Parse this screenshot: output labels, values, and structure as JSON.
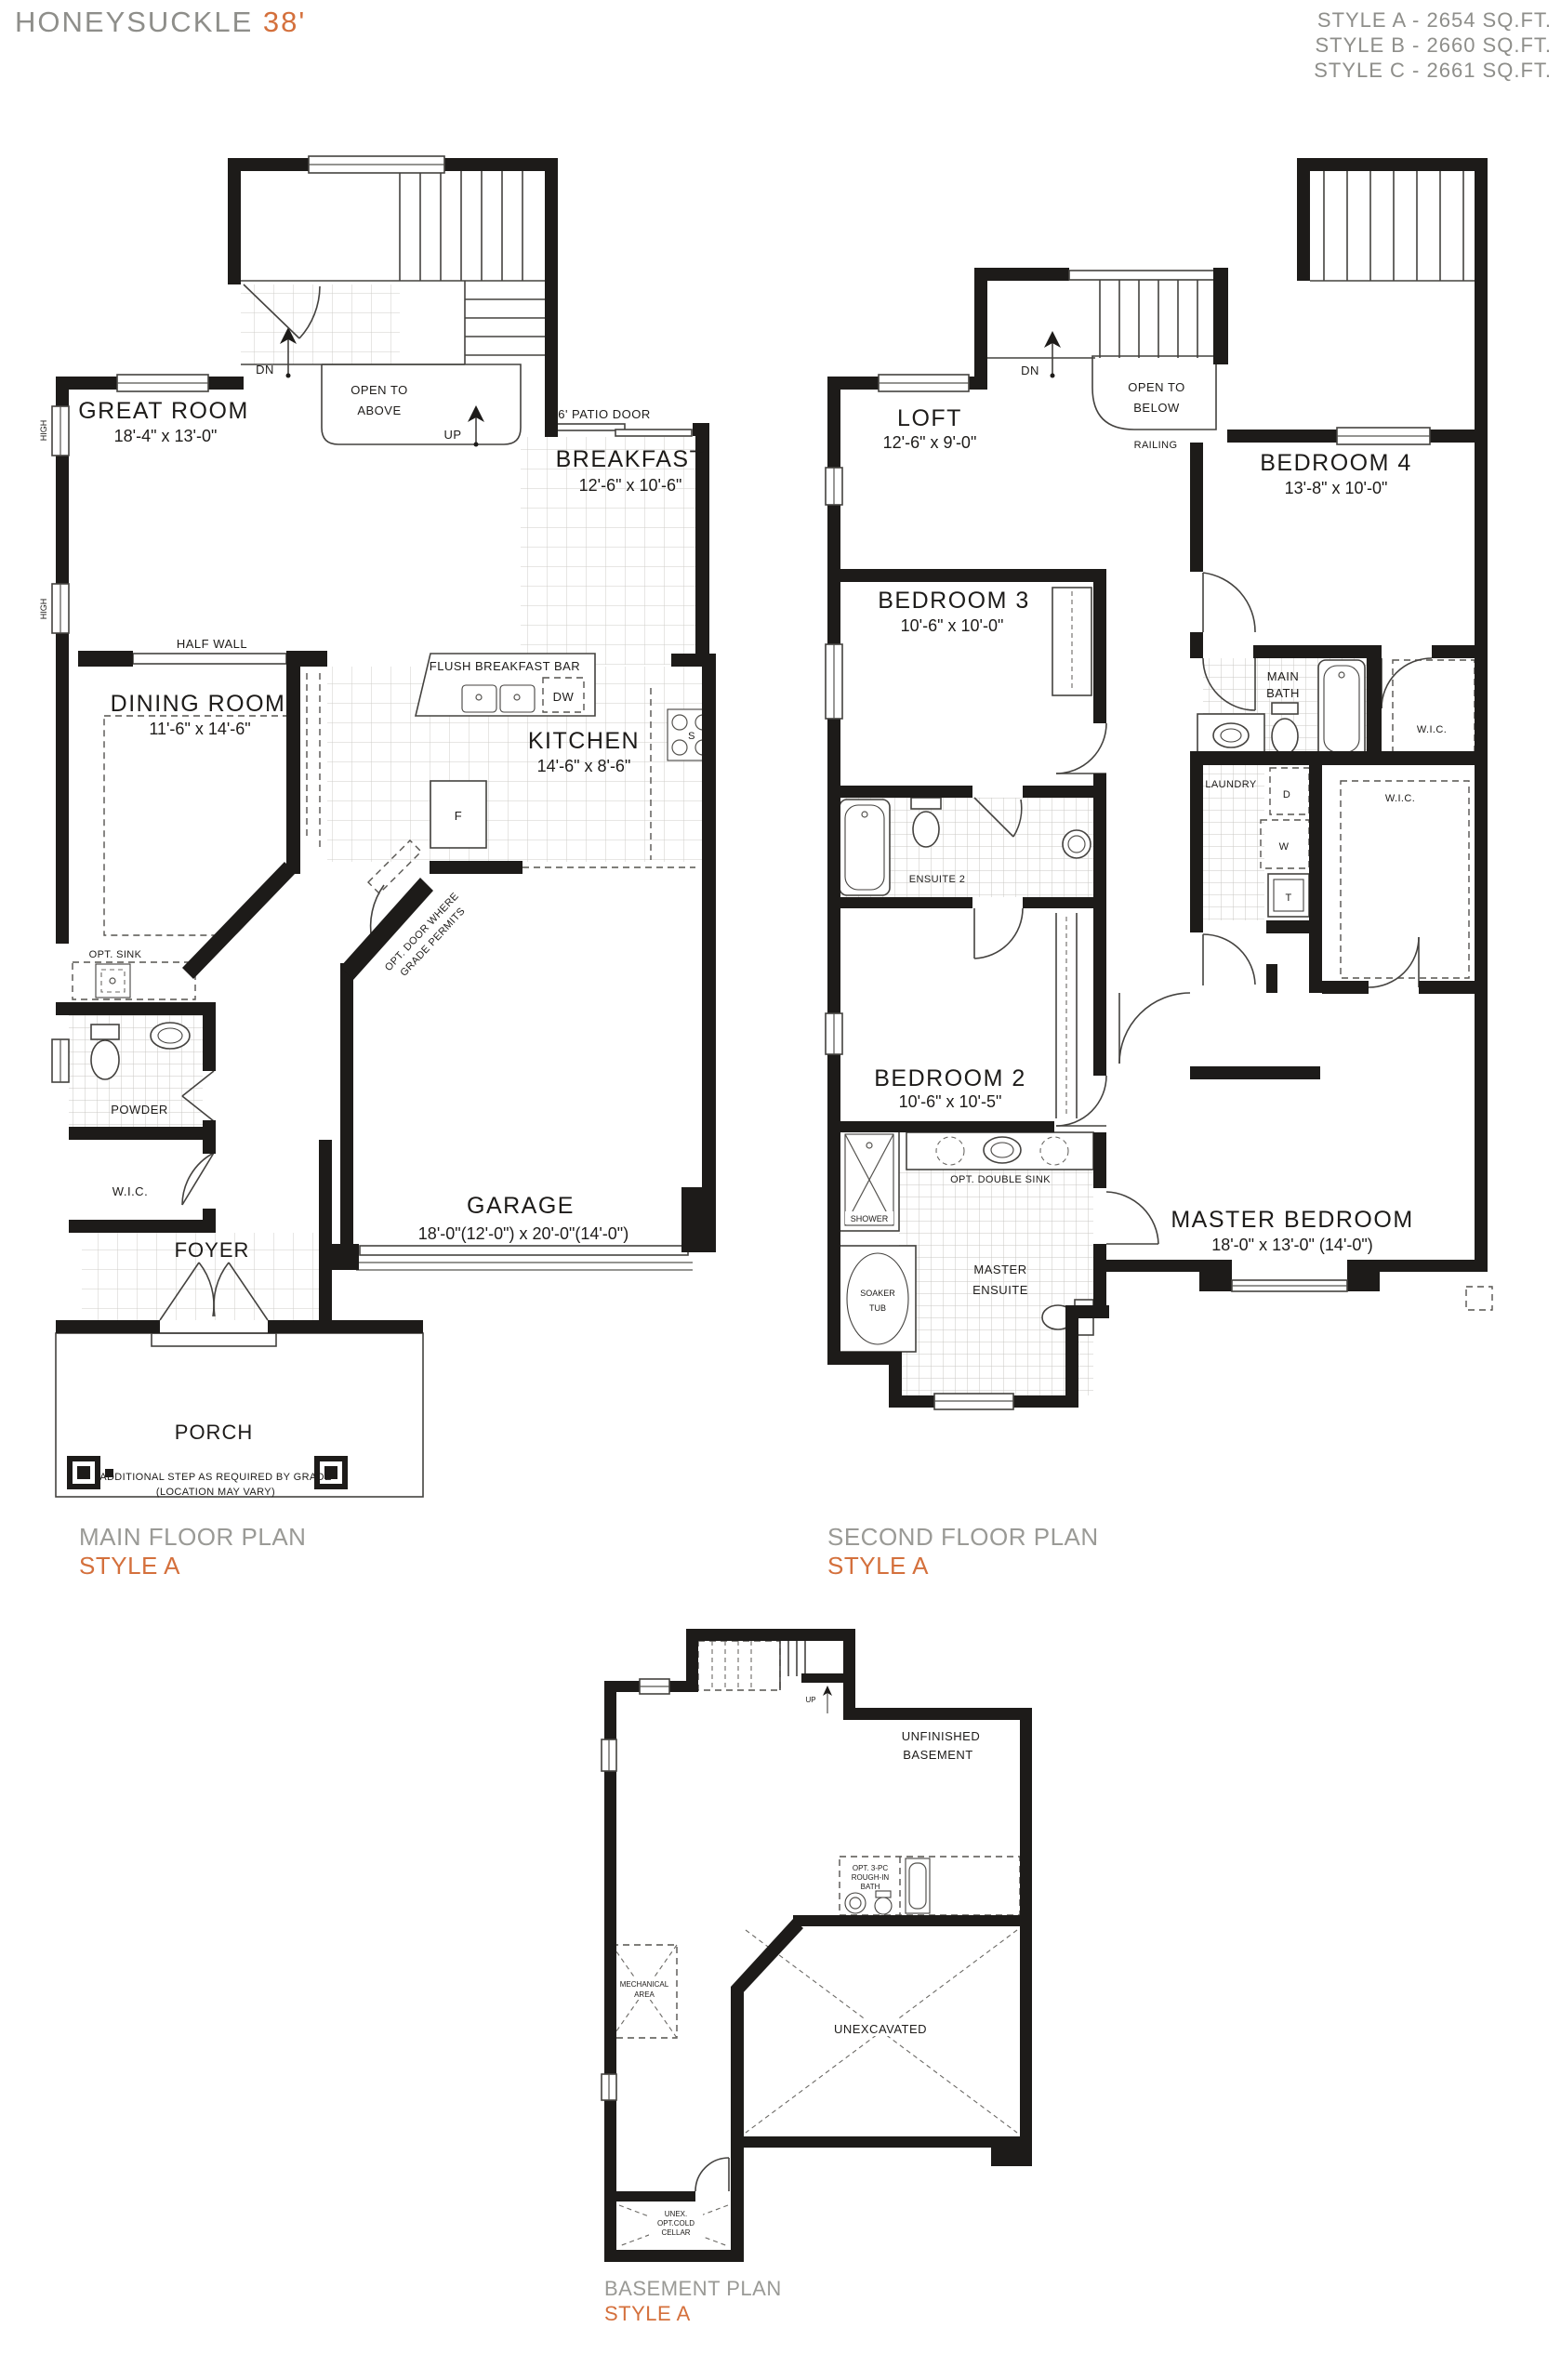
{
  "header": {
    "title_name": "HONEYSUCKLE",
    "title_size": "38'",
    "styles": [
      "STYLE A - 2654 SQ.FT.",
      "STYLE B - 2660 SQ.FT.",
      "STYLE C - 2661 SQ.FT."
    ]
  },
  "colors": {
    "accent": "#D4703C",
    "heading_gray": "#8E8E8A",
    "wall": "#1D1B19"
  },
  "main_floor": {
    "caption": "MAIN FLOOR PLAN",
    "style": "STYLE A",
    "rooms": {
      "great_room": {
        "name": "GREAT ROOM",
        "dims": "18'-4\" x 13'-0\""
      },
      "breakfast": {
        "name": "BREAKFAST",
        "dims": "12'-6\" x 10'-6\""
      },
      "dining_room": {
        "name": "DINING ROOM",
        "dims": "11'-6\" x 14'-6\""
      },
      "kitchen": {
        "name": "KITCHEN",
        "dims": "14'-6\" x 8'-6\""
      },
      "garage": {
        "name": "GARAGE",
        "dims": "18'-0\"(12'-0\") x 20'-0\"(14'-0\")"
      },
      "powder": "POWDER",
      "wic": "W.I.C.",
      "foyer": "FOYER",
      "porch": "PORCH"
    },
    "labels": {
      "high": "HIGH",
      "dn": "DN",
      "up": "UP",
      "open_to_above": [
        "OPEN TO",
        "ABOVE"
      ],
      "patio_door": "6' PATIO DOOR",
      "half_wall": "HALF WALL",
      "flush_breakfast_bar": "FLUSH BREAKFAST BAR",
      "dw": "DW",
      "fridge": "F",
      "stove": "S",
      "opt_sink": "OPT. SINK",
      "opt_door": [
        "OPT. DOOR WHERE",
        "GRADE PERMITS"
      ],
      "step_note": [
        "ADDITIONAL STEP AS REQUIRED BY GRADE",
        "(LOCATION MAY VARY)"
      ]
    }
  },
  "second_floor": {
    "caption": "SECOND FLOOR PLAN",
    "style": "STYLE A",
    "rooms": {
      "loft": {
        "name": "LOFT",
        "dims": "12'-6\" x 9'-0\""
      },
      "bedroom4": {
        "name": "BEDROOM 4",
        "dims": "13'-8\" x 10'-0\""
      },
      "bedroom3": {
        "name": "BEDROOM 3",
        "dims": "10'-6\" x 10'-0\""
      },
      "bedroom2": {
        "name": "BEDROOM 2",
        "dims": "10'-6\" x 10'-5\""
      },
      "master_bedroom": {
        "name": "MASTER BEDROOM",
        "dims": "18'-0\" x 13'-0\" (14'-0\")"
      },
      "main_bath": [
        "MAIN",
        "BATH"
      ],
      "laundry": "LAUNDRY",
      "ensuite2": "ENSUITE 2",
      "master_ensuite": [
        "MASTER",
        "ENSUITE"
      ],
      "wic_bedroom4": "W.I.C.",
      "wic_master": "W.I.C.",
      "shower": "SHOWER",
      "soaker_tub": [
        "SOAKER",
        "TUB"
      ]
    },
    "labels": {
      "dn": "DN",
      "open_to_below": [
        "OPEN TO",
        "BELOW"
      ],
      "railing": "RAILING",
      "opt_double_sink": "OPT. DOUBLE SINK",
      "dryer": "D",
      "washer": "W",
      "tub": "T"
    }
  },
  "basement": {
    "caption": "BASEMENT PLAN",
    "style": "STYLE A",
    "labels": {
      "unfinished": [
        "UNFINISHED",
        "BASEMENT"
      ],
      "up": "UP",
      "opt_bath": [
        "OPT. 3-PC",
        "ROUGH-IN",
        "BATH"
      ],
      "mechanical": [
        "MECHANICAL",
        "AREA"
      ],
      "unexcavated": "UNEXCAVATED",
      "cold_cellar": [
        "UNEX.",
        "OPT.COLD",
        "CELLAR"
      ]
    }
  }
}
